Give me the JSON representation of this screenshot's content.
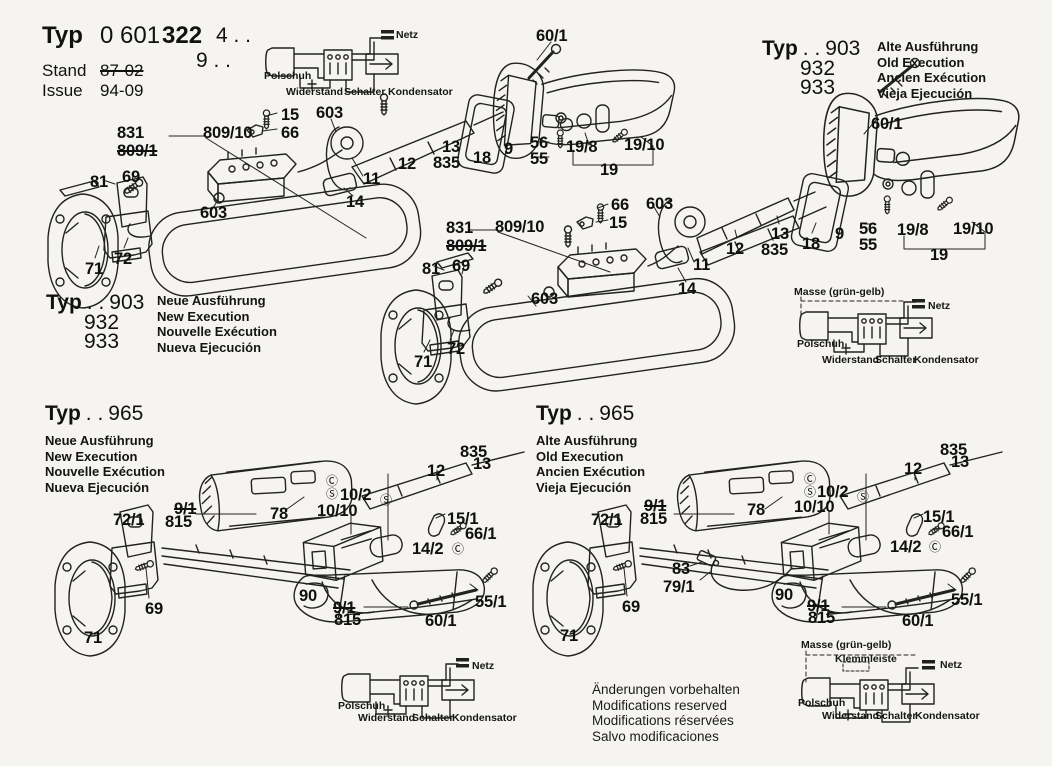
{
  "page": {
    "background": "#f5f4f0",
    "ink": "#222222"
  },
  "title_block": {
    "typ_label": "Typ",
    "typ_number_light": "0 601",
    "typ_number_bold": "322",
    "typ_suffix_line1": "4 . .",
    "typ_suffix_line2": "9 . .",
    "stand_label": "Stand",
    "stand_value": "87-02",
    "issue_label": "Issue",
    "issue_value": "94-09"
  },
  "variants": {
    "top_right": {
      "typ_label": "Typ",
      "dots": ". .",
      "model1": "903",
      "model2": "932",
      "model3": "933",
      "line1": "Alte Ausführung",
      "line2": "Old Execution",
      "line3": "Ancien Exécution",
      "line4": "Vieja Ejecución"
    },
    "mid_left": {
      "typ_label": "Typ",
      "dots": ". .",
      "model1": "903",
      "model2": "932",
      "model3": "933",
      "line1": "Neue Ausführung",
      "line2": "New Execution",
      "line3": "Nouvelle Exécution",
      "line4": "Nueva Ejecución"
    },
    "bottom_left": {
      "typ_label": "Typ",
      "dots": ". .",
      "model1": "965",
      "line1": "Neue Ausführung",
      "line2": "New Execution",
      "line3": "Nouvelle Exécution",
      "line4": "Nueva Ejecución"
    },
    "bottom_right": {
      "typ_label": "Typ",
      "dots": ". .",
      "model1": "965",
      "line1": "Alte Ausführung",
      "line2": "Old Execution",
      "line3": "Ancien Exécution",
      "line4": "Vieja Ejecución"
    }
  },
  "wiring": {
    "netz": "Netz",
    "polschuh": "Polschuh",
    "widerstand": "Widerstand",
    "schalter": "Schalter",
    "kondensator": "Kondensator",
    "masse": "Masse (grün-gelb)",
    "klemmleiste": "Klemmleiste"
  },
  "disclaimer": {
    "line1": "Änderungen vorbehalten",
    "line2": "Modifications reserved",
    "line3": "Modifications réservées",
    "line4": "Salvo modificaciones"
  },
  "callouts": {
    "top_left": [
      "831",
      "809/1",
      "809/10",
      "15",
      "66",
      "603",
      "60/1",
      "81",
      "69",
      "603",
      "71",
      "72",
      "11",
      "14",
      "12",
      "13",
      "835",
      "18",
      "9",
      "56",
      "55",
      "19/8",
      "19/10",
      "19"
    ],
    "top_right": [
      "60/1",
      "12",
      "13",
      "835",
      "18",
      "9",
      "56",
      "55",
      "19/8",
      "19/10",
      "19"
    ],
    "middle": [
      "831",
      "809/1",
      "809/10",
      "66",
      "15",
      "603",
      "81",
      "69",
      "603",
      "71",
      "72",
      "11",
      "14"
    ],
    "bottom_left": [
      "72/1",
      "9/1",
      "815",
      "78",
      "10/10",
      "10/2",
      "Ⓒ",
      "Ⓢ",
      "Ⓢ",
      "12",
      "835",
      "13",
      "15/1",
      "66/1",
      "14/2",
      "Ⓒ",
      "69",
      "71",
      "90",
      "9/1",
      "815",
      "60/1",
      "55/1"
    ],
    "bottom_right": [
      "72/1",
      "9/1",
      "815",
      "78",
      "10/10",
      "10/2",
      "Ⓒ",
      "Ⓢ",
      "Ⓢ",
      "12",
      "835",
      "13",
      "15/1",
      "66/1",
      "14/2",
      "Ⓒ",
      "69",
      "71",
      "90",
      "9/1",
      "815",
      "60/1",
      "55/1",
      "83",
      "79/1"
    ]
  }
}
